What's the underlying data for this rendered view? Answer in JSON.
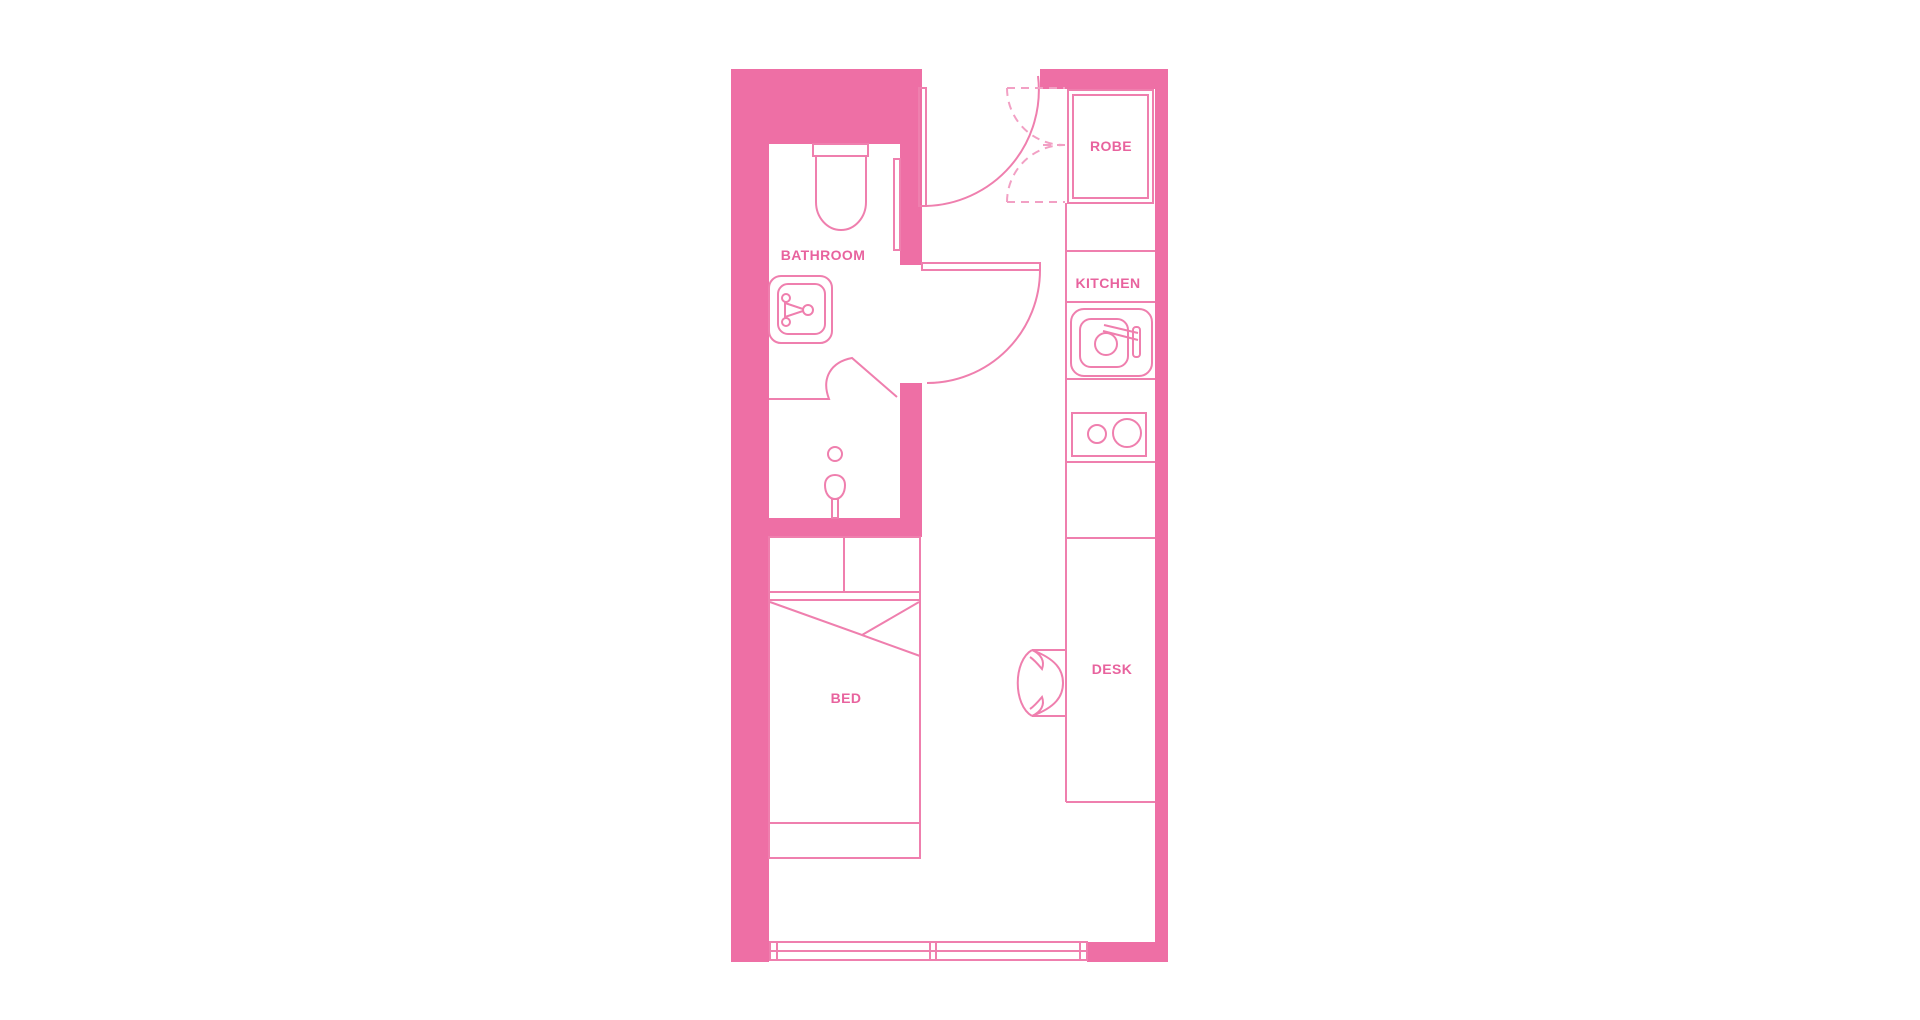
{
  "colors": {
    "background": "#ffffff",
    "wall": "#ee6fa5",
    "line": "#ef7fae",
    "dashed": "#f2a0c4",
    "label": "#e8639e"
  },
  "rooms": [
    {
      "label": "BATHROOM"
    },
    {
      "label": "ROBE"
    },
    {
      "label": "KITCHEN"
    },
    {
      "label": "DESK"
    },
    {
      "label": "BED"
    }
  ],
  "fixtures": {
    "toilet": "svg-shape",
    "basin": "svg-shape",
    "shower": "svg-shape",
    "shower-screen": "svg-shape",
    "entry-door": "svg-arc",
    "bathroom-door": "svg-arc",
    "robe-doors": "svg-dashed-arcs",
    "kitchen-sink": "svg-shape",
    "cooktop": "svg-shape",
    "kitchen-bench": "svg-lines",
    "desk-chair": "svg-shape",
    "bed": "svg-shape",
    "window": "svg-shape"
  }
}
